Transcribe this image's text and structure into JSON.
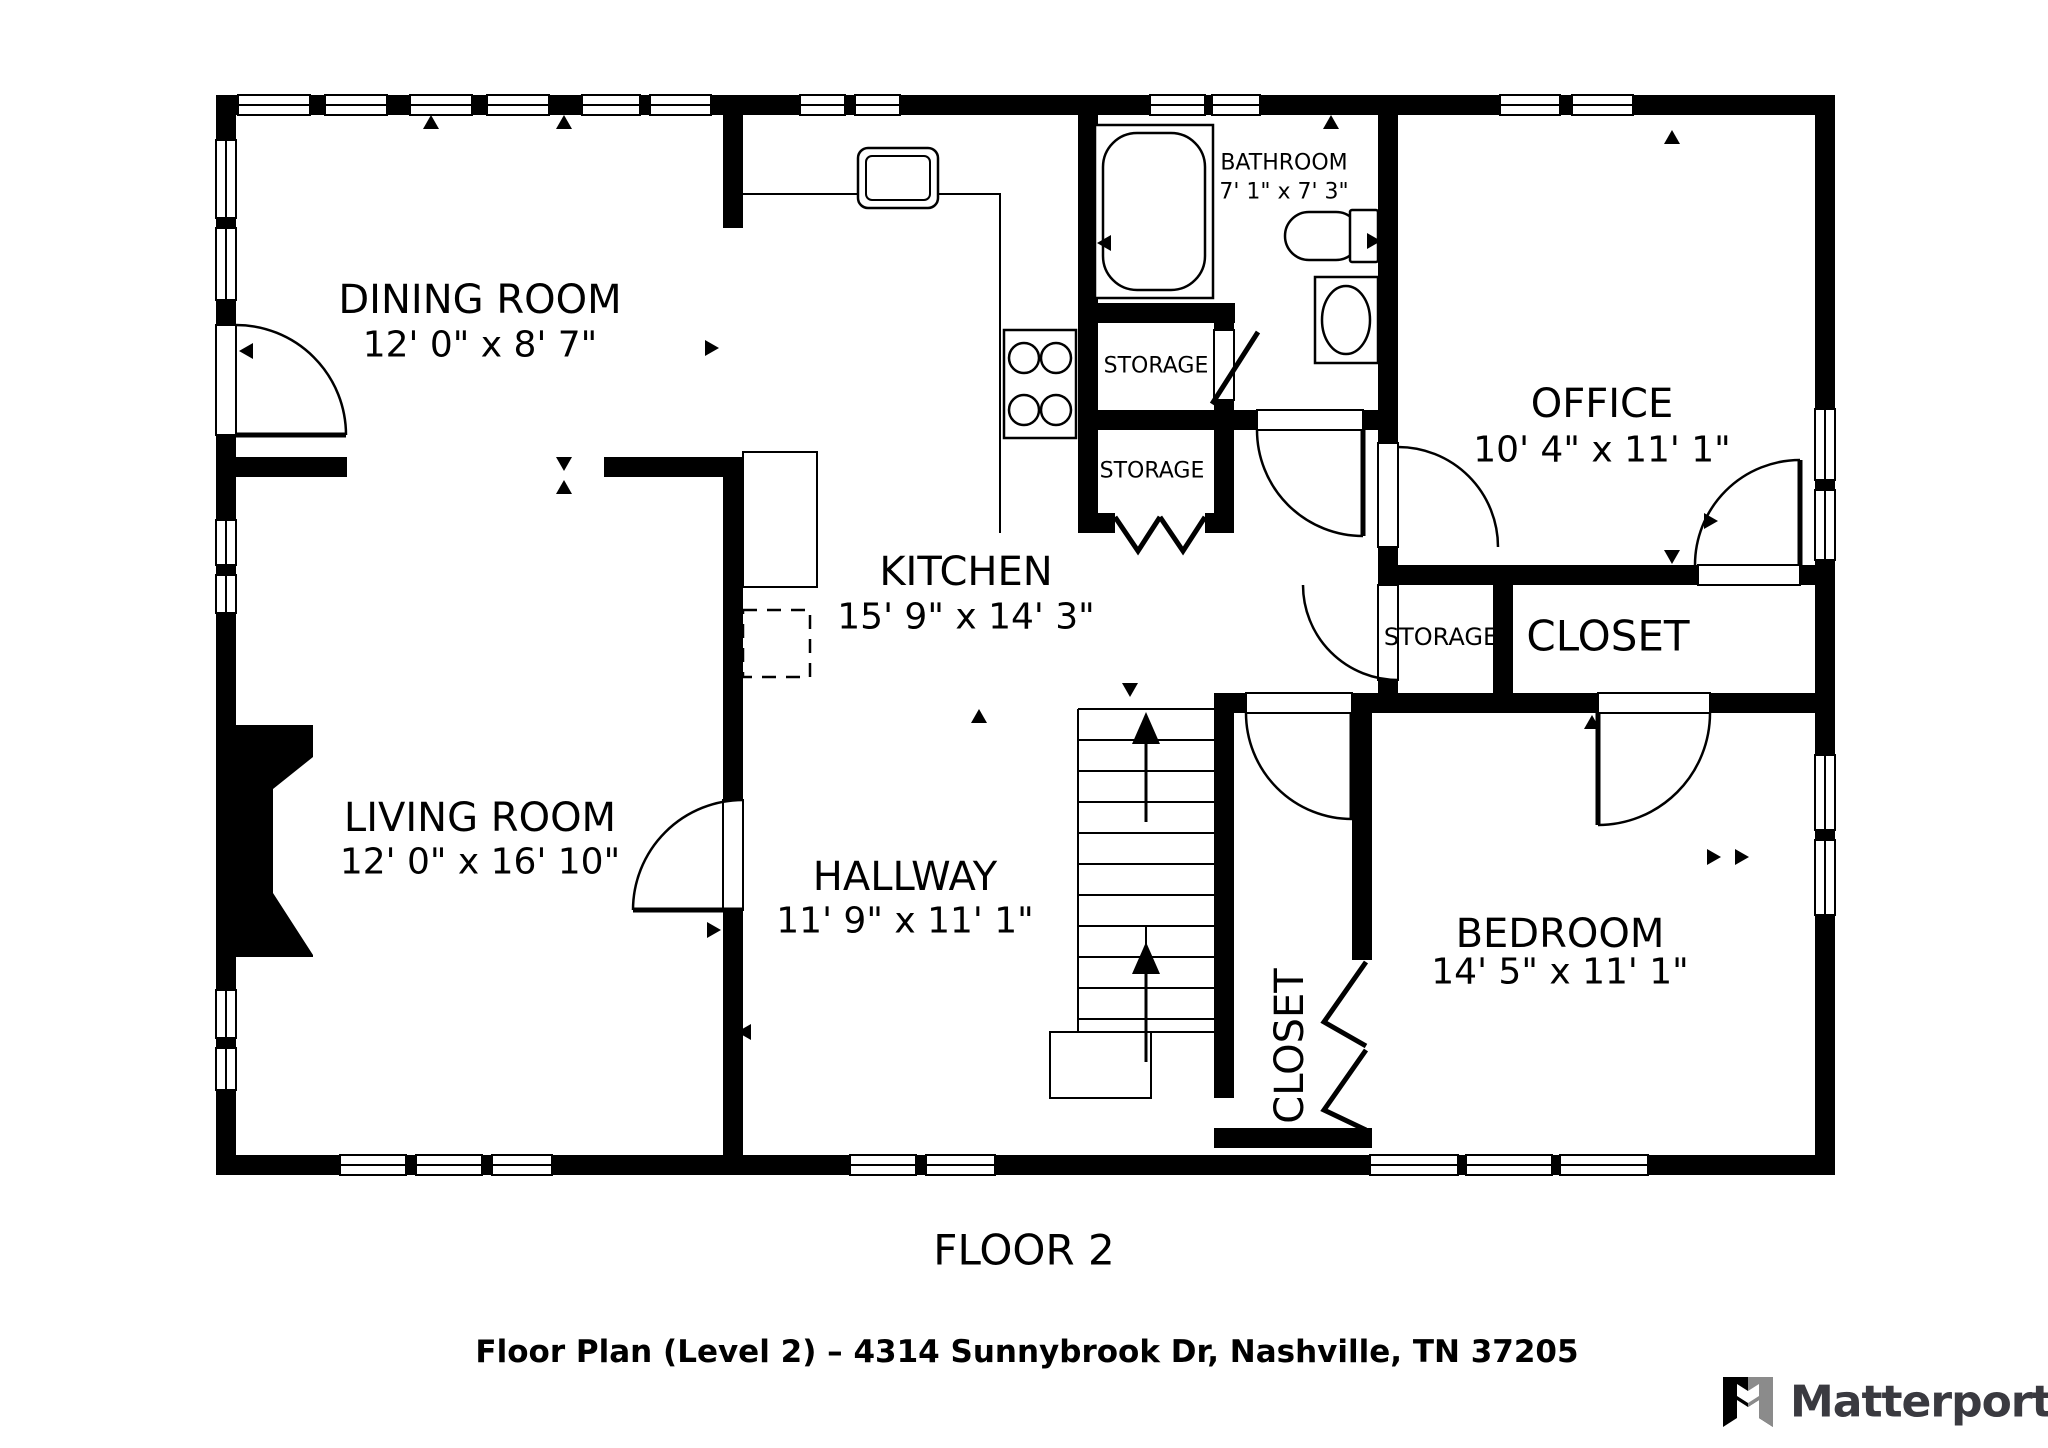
{
  "header": {
    "floor_label": "FLOOR 2"
  },
  "footer": {
    "caption": "Floor Plan (Level 2) – 4314 Sunnybrook Dr, Nashville, TN 37205",
    "brand": "Matterport"
  },
  "rooms": [
    {
      "name": "DINING ROOM",
      "dims": "12' 0\" x 8' 7\""
    },
    {
      "name": "KITCHEN",
      "dims": "15' 9\" x 14' 3\""
    },
    {
      "name": "LIVING ROOM",
      "dims": "12' 0\" x 16' 10\""
    },
    {
      "name": "HALLWAY",
      "dims": "11' 9\" x 11' 1\""
    },
    {
      "name": "BATHROOM",
      "dims": "7' 1\" x 7' 3\""
    },
    {
      "name": "OFFICE",
      "dims": "10' 4\" x 11' 1\""
    },
    {
      "name": "BEDROOM",
      "dims": "14' 5\" x 11' 1\""
    }
  ],
  "small_rooms": {
    "bath_storage_upper": "STORAGE",
    "bath_storage_lower": "STORAGE",
    "hall_storage": "STORAGE",
    "hall_closet": "CLOSET",
    "bedroom_closet": "CLOSET"
  },
  "colors": {
    "wall": "#000000",
    "background": "#ffffff",
    "logo_text": "#3a3a40",
    "logo_gray": "#8b8b8b"
  }
}
